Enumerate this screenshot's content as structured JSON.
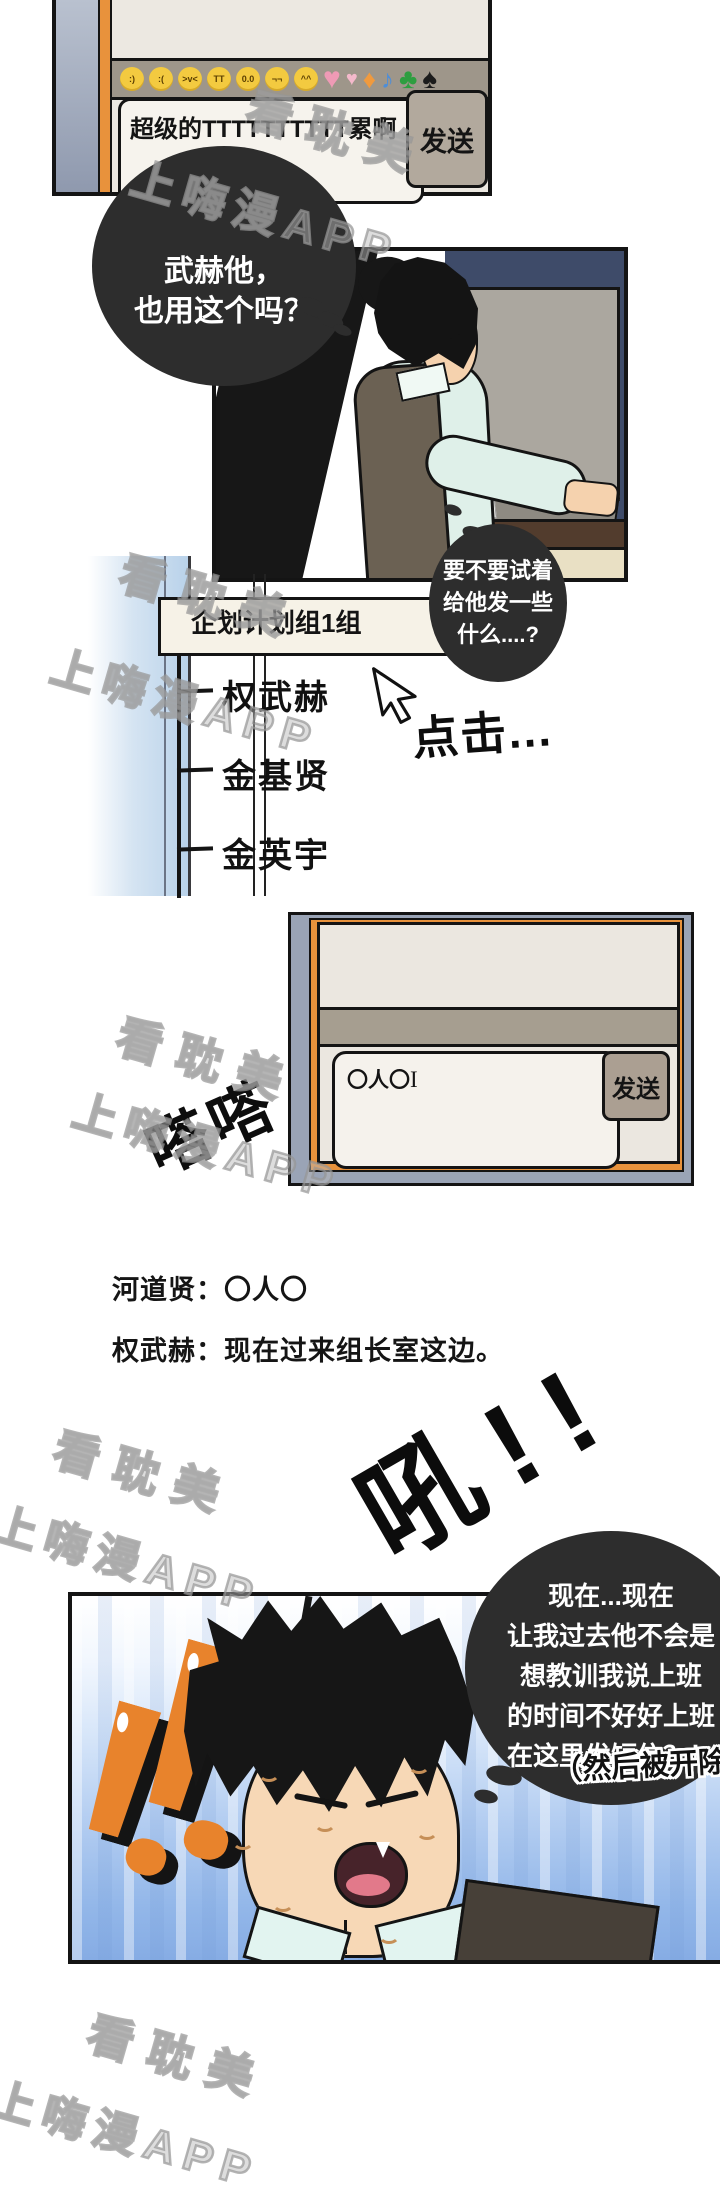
{
  "page_type": "manhwa-comic-page",
  "watermark": {
    "brand": "看耽美",
    "app": "上嗨漫APP"
  },
  "panel_top_chat": {
    "emoji_faces": [
      {
        "name": "smile-face",
        "glyph": ":)"
      },
      {
        "name": "frown-face",
        "glyph": ":("
      },
      {
        "name": "laugh-face",
        "glyph": ">v<"
      },
      {
        "name": "cry-face",
        "glyph": "TT"
      },
      {
        "name": "stare-face",
        "glyph": "0.0"
      },
      {
        "name": "smug-face",
        "glyph": "¬¬"
      },
      {
        "name": "blush-face",
        "glyph": "^^"
      }
    ],
    "emoji_symbols": [
      {
        "name": "heart",
        "glyph": "♥"
      },
      {
        "name": "small-heart",
        "glyph": "♥"
      },
      {
        "name": "diamond",
        "glyph": "♦"
      },
      {
        "name": "music-note",
        "glyph": "♪"
      },
      {
        "name": "club",
        "glyph": "♣"
      },
      {
        "name": "spade",
        "glyph": "♠"
      }
    ],
    "input_value": "超级的TTTTTTTTTT累啊",
    "send_button": "发送"
  },
  "bubble_thought_1": {
    "line1": "武赫他，",
    "line2": "也用这个吗？"
  },
  "bubble_thought_2": {
    "line1": "要不要试着",
    "line2": "给他发一些",
    "line3": "什么....?"
  },
  "messenger_list": {
    "group_title": "企划计划组1组",
    "contacts": [
      "权武赫",
      "金基贤",
      "金英宇"
    ]
  },
  "sfx": {
    "click": "点击...",
    "typing": "嗒嗒",
    "shock": "吼!!"
  },
  "panel_mid_chat": {
    "input_value": "〇人〇",
    "cursor": "I",
    "send_button": "发送"
  },
  "chat_transcript": {
    "line1": "河道贤：〇人〇",
    "line2": "权武赫：现在过来组长室这边。"
  },
  "bubble_thought_3": {
    "line1": "现在...现在",
    "line2": "让我过去他不会是",
    "line3": "想教训我说上班",
    "line4": "的时间不好好上班",
    "line5": "在这里发短信？！"
  },
  "caption_aside": "（然后被开除）",
  "colors": {
    "bubble_black": "#2d2d2d",
    "monitor_bezel": "#9aa4b6",
    "monitor_frame_orange": "#e8923c",
    "panel_cream": "#ece8e1",
    "toolbar_grey": "#9e968a",
    "button_grey": "#b2a99d",
    "exclaim_orange": "#e8832c",
    "background_blue": "#93b7e9"
  }
}
